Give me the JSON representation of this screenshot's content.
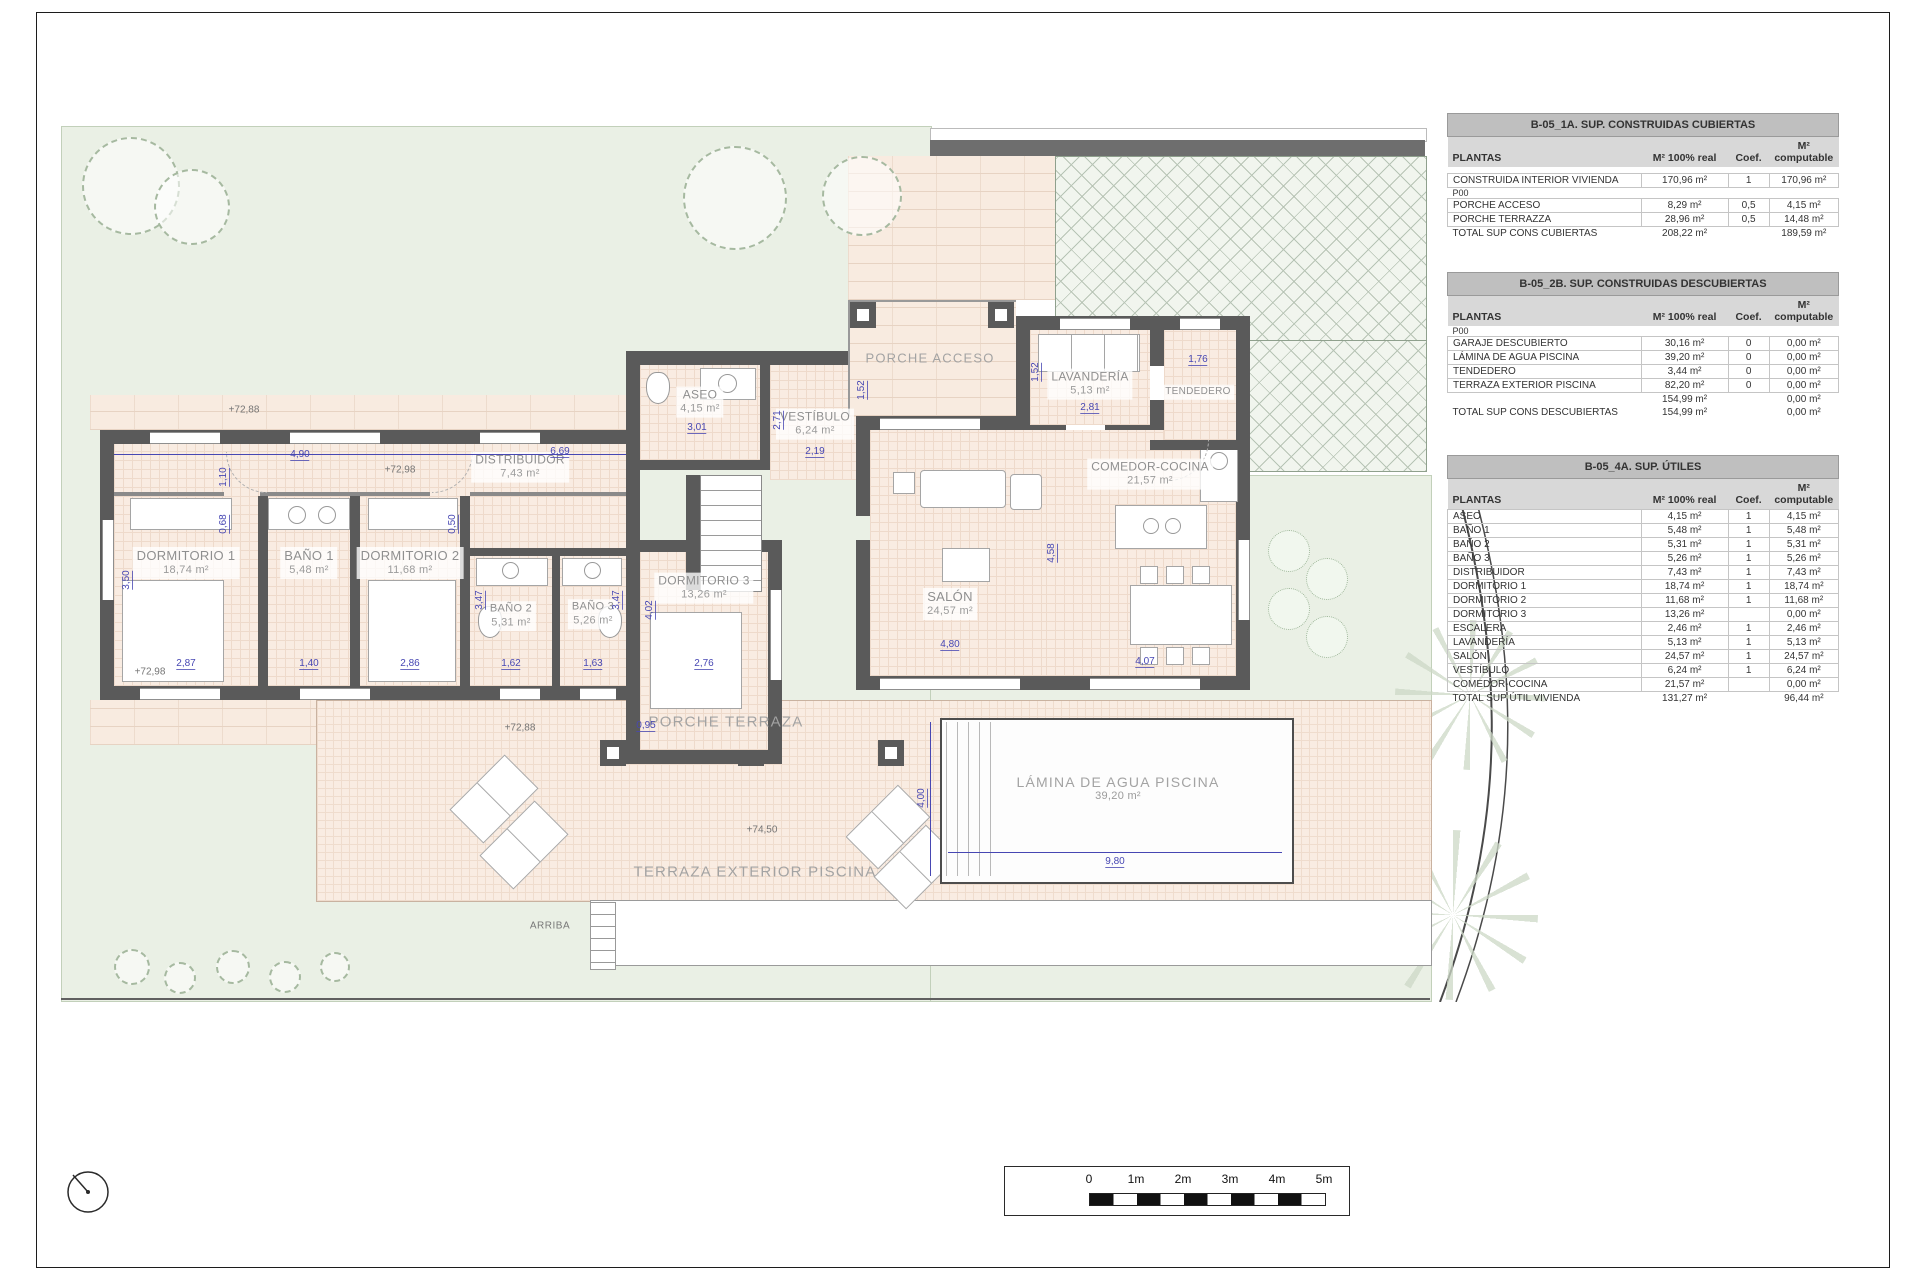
{
  "sheet": {
    "arriba": "ARRIBA"
  },
  "tables": [
    {
      "title": "B-05_1A. SUP. CONSTRUIDAS CUBIERTAS",
      "headers": [
        "PLANTAS",
        "M² 100% real",
        "Coef.",
        "M² computable"
      ],
      "rows": [
        {
          "c": [
            "",
            "",
            "",
            ""
          ],
          "cls": "sp"
        },
        {
          "c": [
            "CONSTRUIDA INTERIOR VIVIENDA",
            "170,96 m²",
            "1",
            "170,96 m²"
          ]
        },
        {
          "c": [
            "P00",
            "",
            "",
            ""
          ],
          "cls": "sec"
        },
        {
          "c": [
            "PORCHE ACCESO",
            "8,29 m²",
            "0,5",
            "4,15 m²"
          ]
        },
        {
          "c": [
            "PORCHE TERRAZZA",
            "28,96 m²",
            "0,5",
            "14,48 m²"
          ]
        },
        {
          "c": [
            "TOTAL SUP CONS CUBIERTAS",
            "208,22 m²",
            "",
            "189,59 m²"
          ],
          "cls": "tot"
        }
      ]
    },
    {
      "title": "B-05_2B. SUP. CONSTRUIDAS DESCUBIERTAS",
      "headers": [
        "PLANTAS",
        "M² 100% real",
        "Coef.",
        "M²\ncomputable"
      ],
      "rows": [
        {
          "c": [
            "P00",
            "",
            "",
            ""
          ],
          "cls": "sec"
        },
        {
          "c": [
            "GARAJE DESCUBIERTO",
            "30,16 m²",
            "0",
            "0,00 m²"
          ]
        },
        {
          "c": [
            "LÁMINA DE AGUA PISCINA",
            "39,20 m²",
            "0",
            "0,00 m²"
          ]
        },
        {
          "c": [
            "TENDEDERO",
            "3,44 m²",
            "0",
            "0,00 m²"
          ]
        },
        {
          "c": [
            "TERRAZA EXTERIOR PISCINA",
            "82,20 m²",
            "0",
            "0,00 m²"
          ]
        },
        {
          "c": [
            "",
            "154,99 m²",
            "",
            "0,00 m²"
          ],
          "cls": "tot"
        },
        {
          "c": [
            "TOTAL SUP CONS DESCUBIERTAS",
            "154,99 m²",
            "",
            "0,00 m²"
          ],
          "cls": "tot"
        }
      ]
    },
    {
      "title": "B-05_4A. SUP. ÚTILES",
      "headers": [
        "PLANTAS",
        "M² 100% real",
        "Coef.",
        "M² computable"
      ],
      "rows": [
        {
          "c": [
            "ASEO",
            "4,15 m²",
            "1",
            "4,15 m²"
          ]
        },
        {
          "c": [
            "BAÑO 1",
            "5,48 m²",
            "1",
            "5,48 m²"
          ]
        },
        {
          "c": [
            "BAÑO 2",
            "5,31 m²",
            "1",
            "5,31 m²"
          ]
        },
        {
          "c": [
            "BAÑO 3",
            "5,26 m²",
            "1",
            "5,26 m²"
          ]
        },
        {
          "c": [
            "DISTRIBUIDOR",
            "7,43 m²",
            "1",
            "7,43 m²"
          ]
        },
        {
          "c": [
            "DORMITORIO 1",
            "18,74 m²",
            "1",
            "18,74 m²"
          ]
        },
        {
          "c": [
            "DORMITORIO 2",
            "11,68 m²",
            "1",
            "11,68 m²"
          ]
        },
        {
          "c": [
            "DORMITORIO 3",
            "13,26 m²",
            "",
            "0,00 m²"
          ]
        },
        {
          "c": [
            "ESCALERA",
            "2,46 m²",
            "1",
            "2,46 m²"
          ]
        },
        {
          "c": [
            "LAVANDERÍA",
            "5,13 m²",
            "1",
            "5,13 m²"
          ]
        },
        {
          "c": [
            "SALÓN",
            "24,57 m²",
            "1",
            "24,57 m²"
          ]
        },
        {
          "c": [
            "VESTÍBULO",
            "6,24 m²",
            "1",
            "6,24 m²"
          ]
        },
        {
          "c": [
            "COMEDOR-COCINA",
            "21,57 m²",
            "",
            "0,00 m²"
          ]
        },
        {
          "c": [
            "TOTAL SUP ÚTIL VIVIENDA",
            "131,27 m²",
            "",
            "96,44 m²"
          ],
          "cls": "tot"
        }
      ]
    }
  ],
  "plan": {
    "rooms": [
      {
        "name": "DORMITORIO 1",
        "area": "18,74 m²"
      },
      {
        "name": "BAÑO 1",
        "area": "5,48 m²"
      },
      {
        "name": "DORMITORIO 2",
        "area": "11,68 m²"
      },
      {
        "name": "BAÑO 2",
        "area": "5,31 m²"
      },
      {
        "name": "BAÑO 3",
        "area": "5,26 m²"
      },
      {
        "name": "DORMITORIO 3",
        "area": "13,26 m²"
      },
      {
        "name": "DISTRIBUIDOR",
        "area": "7,43 m²"
      },
      {
        "name": "ASEO",
        "area": "4,15 m²"
      },
      {
        "name": "VESTÍBULO",
        "area": "6,24 m²"
      },
      {
        "name": "SALÓN",
        "area": "24,57 m²"
      },
      {
        "name": "COMEDOR-COCINA",
        "area": "21,57 m²"
      },
      {
        "name": "LAVANDERÍA",
        "area": "5,13 m²"
      },
      {
        "name": "TENDEDERO",
        "area": ""
      }
    ],
    "zones": {
      "porche_acceso": "PORCHE ACCESO",
      "porche_terraza": "PORCHE TERRAZA",
      "terraza_ext": "TERRAZA EXTERIOR PISCINA",
      "lamina": "LÁMINA DE AGUA PISCINA",
      "lamina_area": "39,20 m²"
    },
    "dims": [
      "2,87",
      "1,40",
      "2,86",
      "1,62",
      "1,63",
      "2,76",
      "3,50",
      "3,47",
      "3,47",
      "0,68",
      "1,10",
      "0,50",
      "4,90",
      "6,69",
      "0,95",
      "4,02",
      "2,71",
      "2,19",
      "1,52",
      "3,01",
      "1,52",
      "2,81",
      "1,76",
      "4,80",
      "4,07",
      "4,58",
      "4,00",
      "9,80"
    ],
    "levels": [
      "+72,88",
      "+72,98",
      "+72,98",
      "+72,88",
      "+74,50"
    ]
  },
  "scalebar": {
    "labels": [
      "0",
      "1m",
      "2m",
      "3m",
      "4m",
      "5m"
    ]
  }
}
